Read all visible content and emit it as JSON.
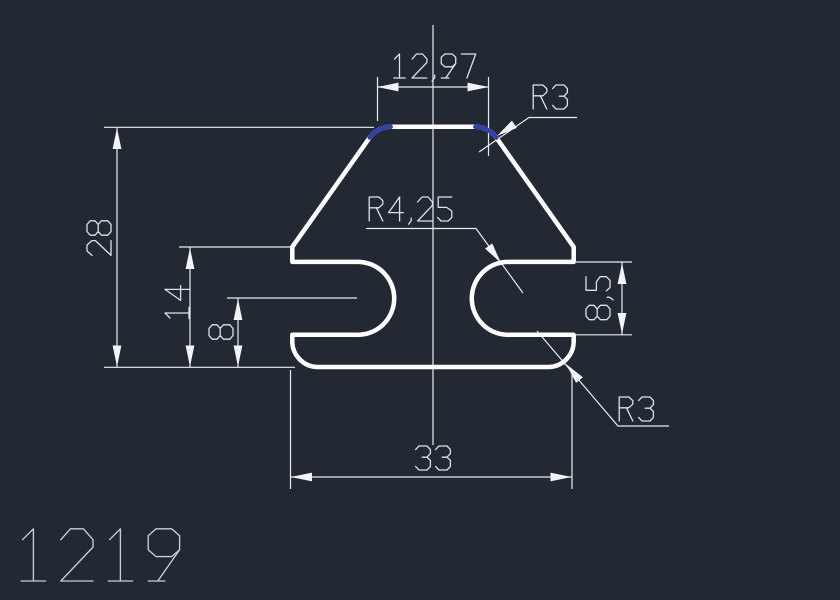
{
  "drawing": {
    "type": "profile-cross-section",
    "part_number": "1219",
    "dimensions": [
      {
        "id": "top-width",
        "label": "12,97"
      },
      {
        "id": "top-corner-radius",
        "label": "R3"
      },
      {
        "id": "slot-radius",
        "label": "R4,25"
      },
      {
        "id": "total-height",
        "label": "28"
      },
      {
        "id": "shoulder-height",
        "label": "14"
      },
      {
        "id": "slot-center-height",
        "label": "8"
      },
      {
        "id": "slot-opening-height",
        "label": "8,5"
      },
      {
        "id": "bottom-width",
        "label": "33"
      },
      {
        "id": "bottom-corner-radius",
        "label": "R3"
      }
    ],
    "colors": {
      "background": "#222933",
      "outline": "#ffffff",
      "fillet_arc": "#3241af",
      "dimension_line": "#e9ecf1",
      "arrow": "#f2f4f7",
      "text": "#dde2e9",
      "part_number_text": "#c9cfd9"
    }
  }
}
